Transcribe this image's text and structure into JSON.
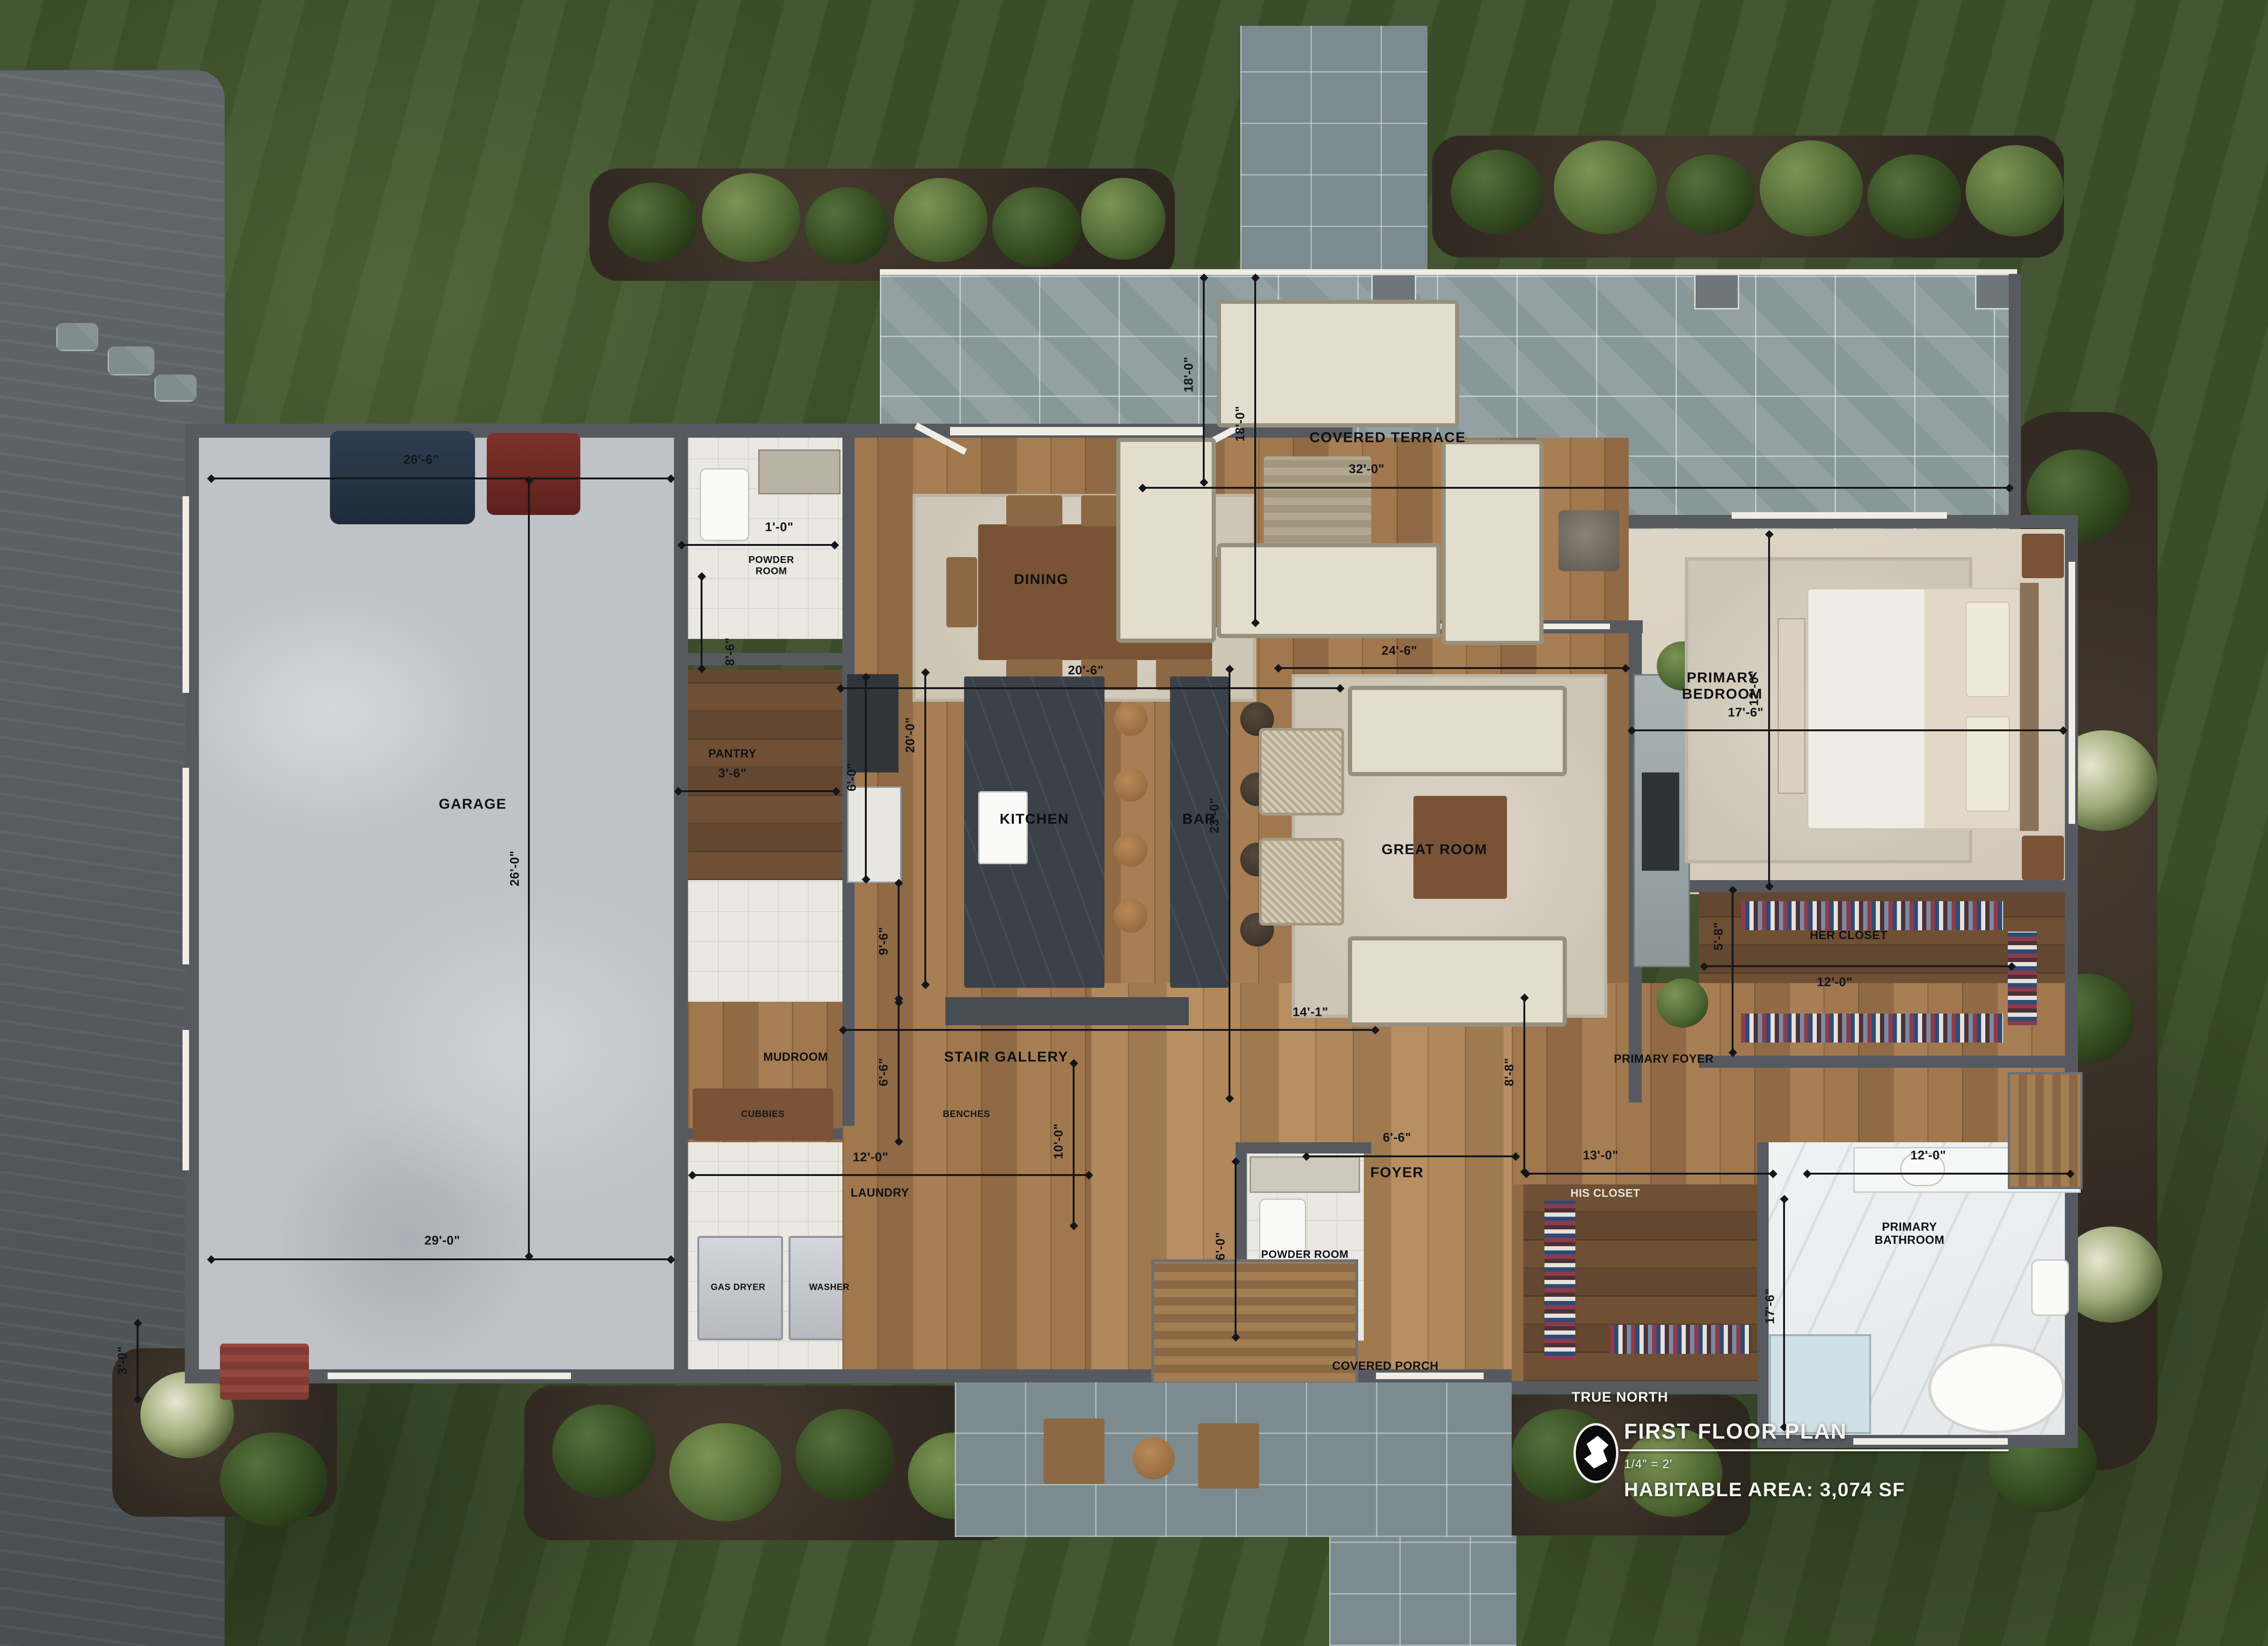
{
  "meta": {
    "kind": "first-floor-plan-aerial-render"
  },
  "title_block": {
    "north_label": "TRUE NORTH",
    "title": "FIRST FLOOR PLAN",
    "scale": "1/4\" = 2'",
    "area": "HABITABLE AREA: 3,074 SF"
  },
  "rooms": {
    "garage": "GARAGE",
    "powder_top": "POWDER ROOM",
    "pantry": "PANTRY",
    "kitchen": "KITCHEN",
    "bar": "BAR",
    "dining": "DINING",
    "covered_terrace": "COVERED TERRACE",
    "great_room": "GREAT ROOM",
    "primary_bedroom": "PRIMARY BEDROOM",
    "her_closet": "HER CLOSET",
    "mudroom": "MUDROOM",
    "stair_gallery": "STAIR GALLERY",
    "laundry": "LAUNDRY",
    "foyer": "FOYER",
    "powder_lower": "POWDER ROOM",
    "primary_foyer": "PRIMARY FOYER",
    "his_closet": "HIS CLOSET",
    "primary_bathroom": "PRIMARY BATHROOM",
    "covered_porch": "COVERED PORCH"
  },
  "fixtures": {
    "cubbies": "CUBBIES",
    "benches": "BENCHES",
    "gas_dryer": "GAS DRYER",
    "washer": "WASHER"
  },
  "dims": {
    "garage_width_top": "26'-6\"",
    "garage_depth": "26'-0\"",
    "garage_width_bottom": "29'-0\"",
    "garage_bay": "3'-0\"",
    "powder_top_width": "1'-0\"",
    "entry_hall_height": "8'-6\"",
    "pantry_width": "3'-6\"",
    "pantry_depth": "6'-0\"",
    "side_hall_depth": "9'-6\"",
    "mudroom_depth": "6'-6\"",
    "kitchen_length": "20'-0\"",
    "dining_width": "20'-6\"",
    "terrace_width": "32'-0\"",
    "terrace_depth_a": "18'-0\"",
    "terrace_depth_b": "18'-0\"",
    "great_room_width": "24'-6\"",
    "great_room_depth": "23'-0\"",
    "bedroom_width": "17'-6\"",
    "bedroom_depth": "12'-0\"",
    "her_closet_width": "12'-0\"",
    "her_closet_depth": "5'-8\"",
    "stair_gallery_width": "14'-1\"",
    "stair_gallery_depth": "10'-0\"",
    "laundry_width": "12'-0\"",
    "foyer_width": "6'-6\"",
    "powder_lower_depth": "6'-0\"",
    "primary_foyer_depth": "8'-8\"",
    "his_closet_width": "13'-0\"",
    "bathroom_width": "12'-0\"",
    "bathroom_depth": "17'-6\""
  },
  "palette": {
    "lawn": "#3c4f2a",
    "driveway": "#5b6165",
    "bluestone": "#93a1a4",
    "wood_floor": "#9a744e",
    "wall": "#565a60",
    "trim": "#f0ede4",
    "annotation": "#15161a",
    "title_text": "#f4f3ef"
  }
}
